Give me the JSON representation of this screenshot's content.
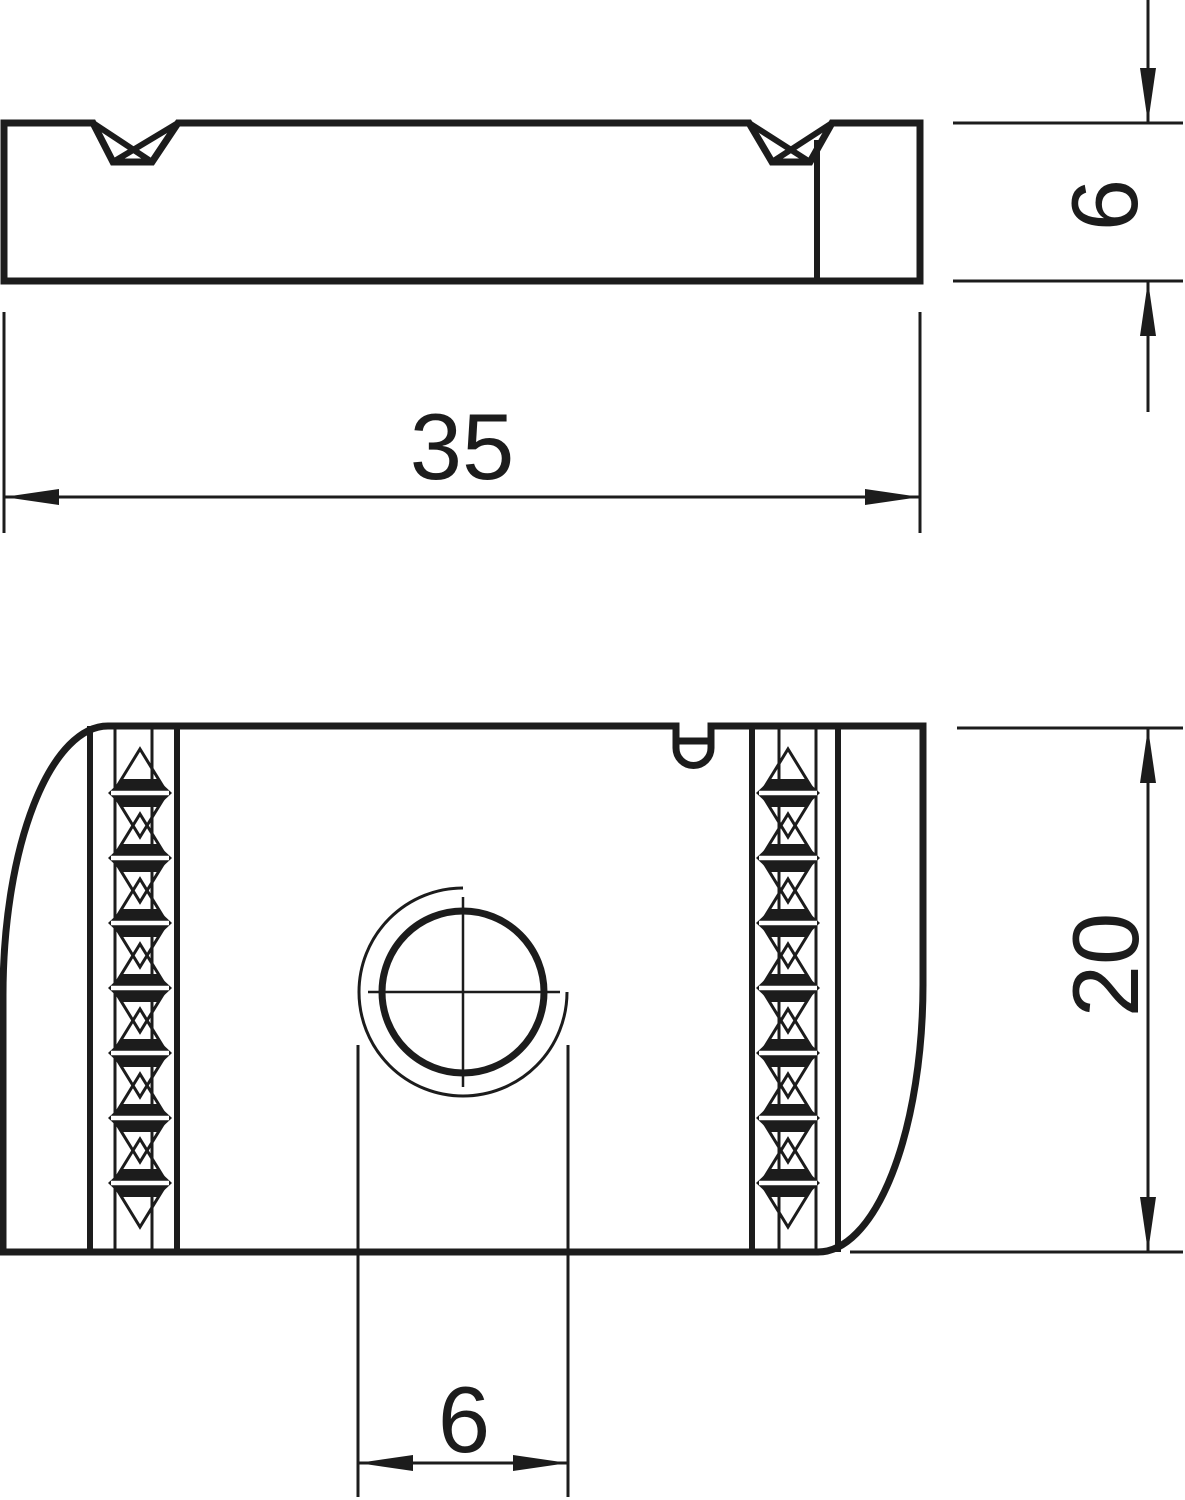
{
  "drawing": {
    "colors": {
      "line": "#1c1c1c",
      "background": "#ffffff"
    },
    "dimensions": {
      "length": "35",
      "thickness": "6",
      "width": "20",
      "hole": "6"
    }
  }
}
